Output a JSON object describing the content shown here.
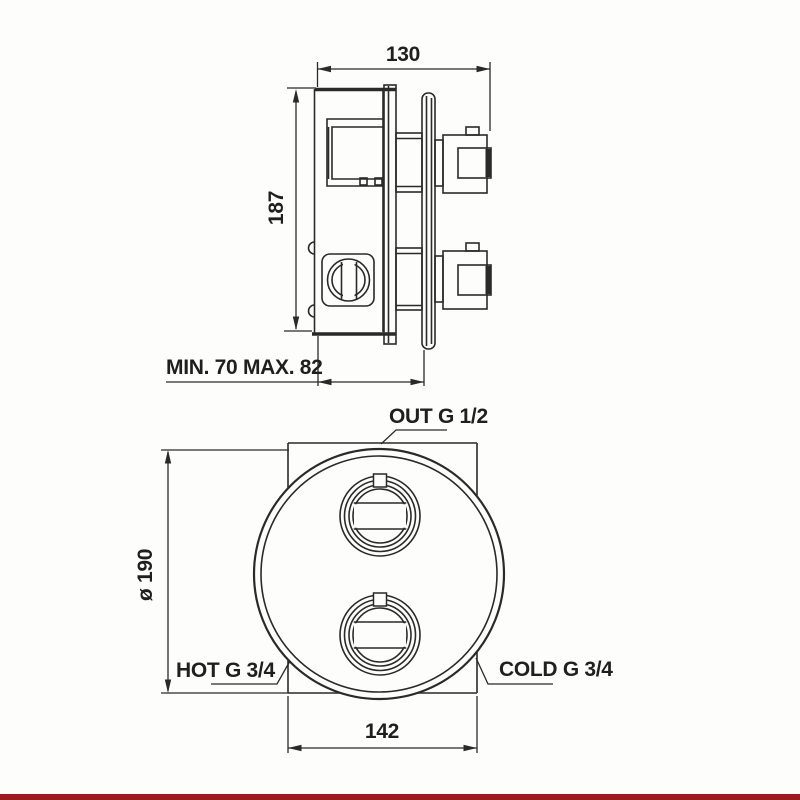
{
  "drawing": {
    "type": "technical-spec-drawing",
    "subject": "concealed-thermostatic-shower-valve",
    "side_view": {
      "width_dim": "130",
      "height_dim": "187",
      "depth_dim": "MIN. 70 MAX. 82"
    },
    "front_view": {
      "outlet_dim": "OUT G 1/2",
      "diameter_dim": "ø 190",
      "hot_dim": "HOT G 3/4",
      "cold_dim": "COLD G 3/4",
      "width_dim": "142"
    },
    "colors": {
      "line": "#2a2a2a",
      "text": "#1f1f1f",
      "accent_bar": "#9c1b1e",
      "background": "#fdfdfb"
    }
  }
}
